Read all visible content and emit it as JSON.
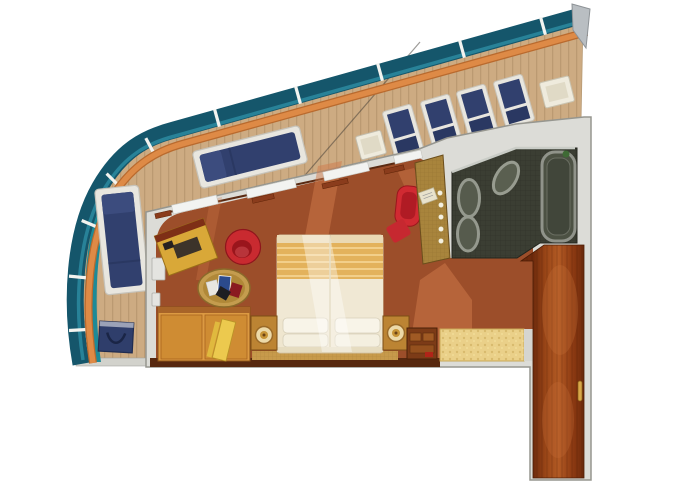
{
  "meta": {
    "title": "cruise-ship-suite-floor-plan",
    "description": "Top-down 3D rendered floor plan of a cruise ship stateroom with curved wrap-around balcony, bedroom, spa bathroom and entry corridor",
    "canvas": {
      "width": 680,
      "height": 486
    }
  },
  "colors": {
    "background": "#ffffff",
    "glass": "#15566b",
    "glass_highlight": "#2b8aa0",
    "handrail": "#de8a46",
    "handrail_dark": "#b96a2e",
    "post_white": "#f3f3ef",
    "end_cap": "#b9bec2",
    "deck_wood": "#cdab82",
    "deck_plank_line": "#b5946c",
    "deck_edge_teal": "#1d8a97",
    "deck_edge_gray": "#d2d2cc",
    "wall_gray": "#dcdcd7",
    "wall_outline": "#96968f",
    "wall_trim": "#5a2a12",
    "carpet": "#9c4e2a",
    "carpet_light": "#cf7a4a",
    "navy": "#31406e",
    "navy_dark": "#2a3862",
    "navy_light": "#3c4c7e",
    "chair_frame": "#e8e6df",
    "white_furniture": "#efebdd",
    "white_furniture_inner": "#e0dac6",
    "bed_cream": "#efe6cf",
    "bed_cream_dark": "#e6dcc0",
    "bed_stripe_gold": "#e3b25c",
    "bed_stripe_light": "#f2cf8a",
    "pillow": "#f8f4e8",
    "nightstand": "#bc8433",
    "nightstand_dark": "#7c4e16",
    "lamp_ring": "#ecd9a8",
    "lamp_gold": "#c79436",
    "wardrobe": "#dc9a42",
    "wardrobe_dark": "#8a5218",
    "board_yellow": "#ecc94e",
    "desk_gold": "#d9a838",
    "desk_shelf_red": "#7e2f16",
    "blotter": "#3c332a",
    "red_chair": "#c92a30",
    "red_chair_dark": "#9a151c",
    "red_chaise": "#d02a32",
    "table_wicker": "#c49c4e",
    "table_wicker_dark": "#b08838",
    "vanity_gold": "#a8843c",
    "bath_floor": "#3b3e33",
    "bath_wall_light": "#c9ccc6",
    "tub_fill": "#4c5143",
    "tub_rim": "#90938a",
    "tub_inner": "#41463a",
    "oval_fill": "#565b4d",
    "oval_rim": "#95998e",
    "plant_green": "#3f6a35",
    "entry_floor": "#ead089",
    "entry_floor_edge": "#c9a855",
    "corridor_wood": "#9a4617",
    "corridor_outline": "#4a1d06",
    "bottom_wall": "#57280f",
    "runner_gold": "#c79a4b",
    "cabinet_dark": "#7c3b17",
    "cabinet_mid": "#a05a24",
    "handle_gold": "#d9a84a",
    "bag_navy": "#2f3e6b"
  },
  "balcony": {
    "railing": {
      "glass_panels": true,
      "post_count": 10,
      "handrail_material": "teak"
    },
    "furniture": [
      {
        "name": "sun-lounger-top",
        "color": "navy",
        "position": "upper-left-deck"
      },
      {
        "name": "sun-lounger-left",
        "color": "navy",
        "position": "left-deck"
      },
      {
        "name": "deck-chair",
        "count": 4,
        "color": "navy",
        "position": "upper-right-deck"
      },
      {
        "name": "deck-chair-white",
        "count": 1,
        "color": "cream",
        "position": "upper-deck"
      },
      {
        "name": "side-table",
        "count": 1,
        "color": "white",
        "position": "top-right-deck"
      },
      {
        "name": "beach-bag",
        "count": 1,
        "color": "navy",
        "position": "bottom-left-deck"
      }
    ]
  },
  "bedroom": {
    "floor": "rust-carpet",
    "furniture": [
      {
        "name": "double-bed",
        "pillows": 4,
        "blanket": "gold-striped"
      },
      {
        "name": "nightstand",
        "count": 2,
        "lamp": true
      },
      {
        "name": "wardrobe",
        "count": 1
      },
      {
        "name": "ironing-board",
        "count": 1
      },
      {
        "name": "desk",
        "count": 1
      },
      {
        "name": "tub-chair",
        "color": "red"
      },
      {
        "name": "coffee-table",
        "style": "wicker",
        "items": "magazines"
      },
      {
        "name": "chaise",
        "color": "red"
      },
      {
        "name": "vanity",
        "style": "gold-mosaic",
        "lights": 5
      },
      {
        "name": "media-cabinet",
        "count": 1
      }
    ],
    "windows_on_balcony_wall": 4
  },
  "bathroom": {
    "floor": "dark-mosaic",
    "fixtures": [
      {
        "name": "whirlpool-tub",
        "shape": "rounded-rectangle"
      },
      {
        "name": "oval-basin",
        "count": 2
      },
      {
        "name": "oval-basin-tilted",
        "count": 1
      }
    ]
  },
  "entry": {
    "floor": "speckled-gold-marble",
    "corridor_floor": "mahogany-wood",
    "door_handle": true
  }
}
